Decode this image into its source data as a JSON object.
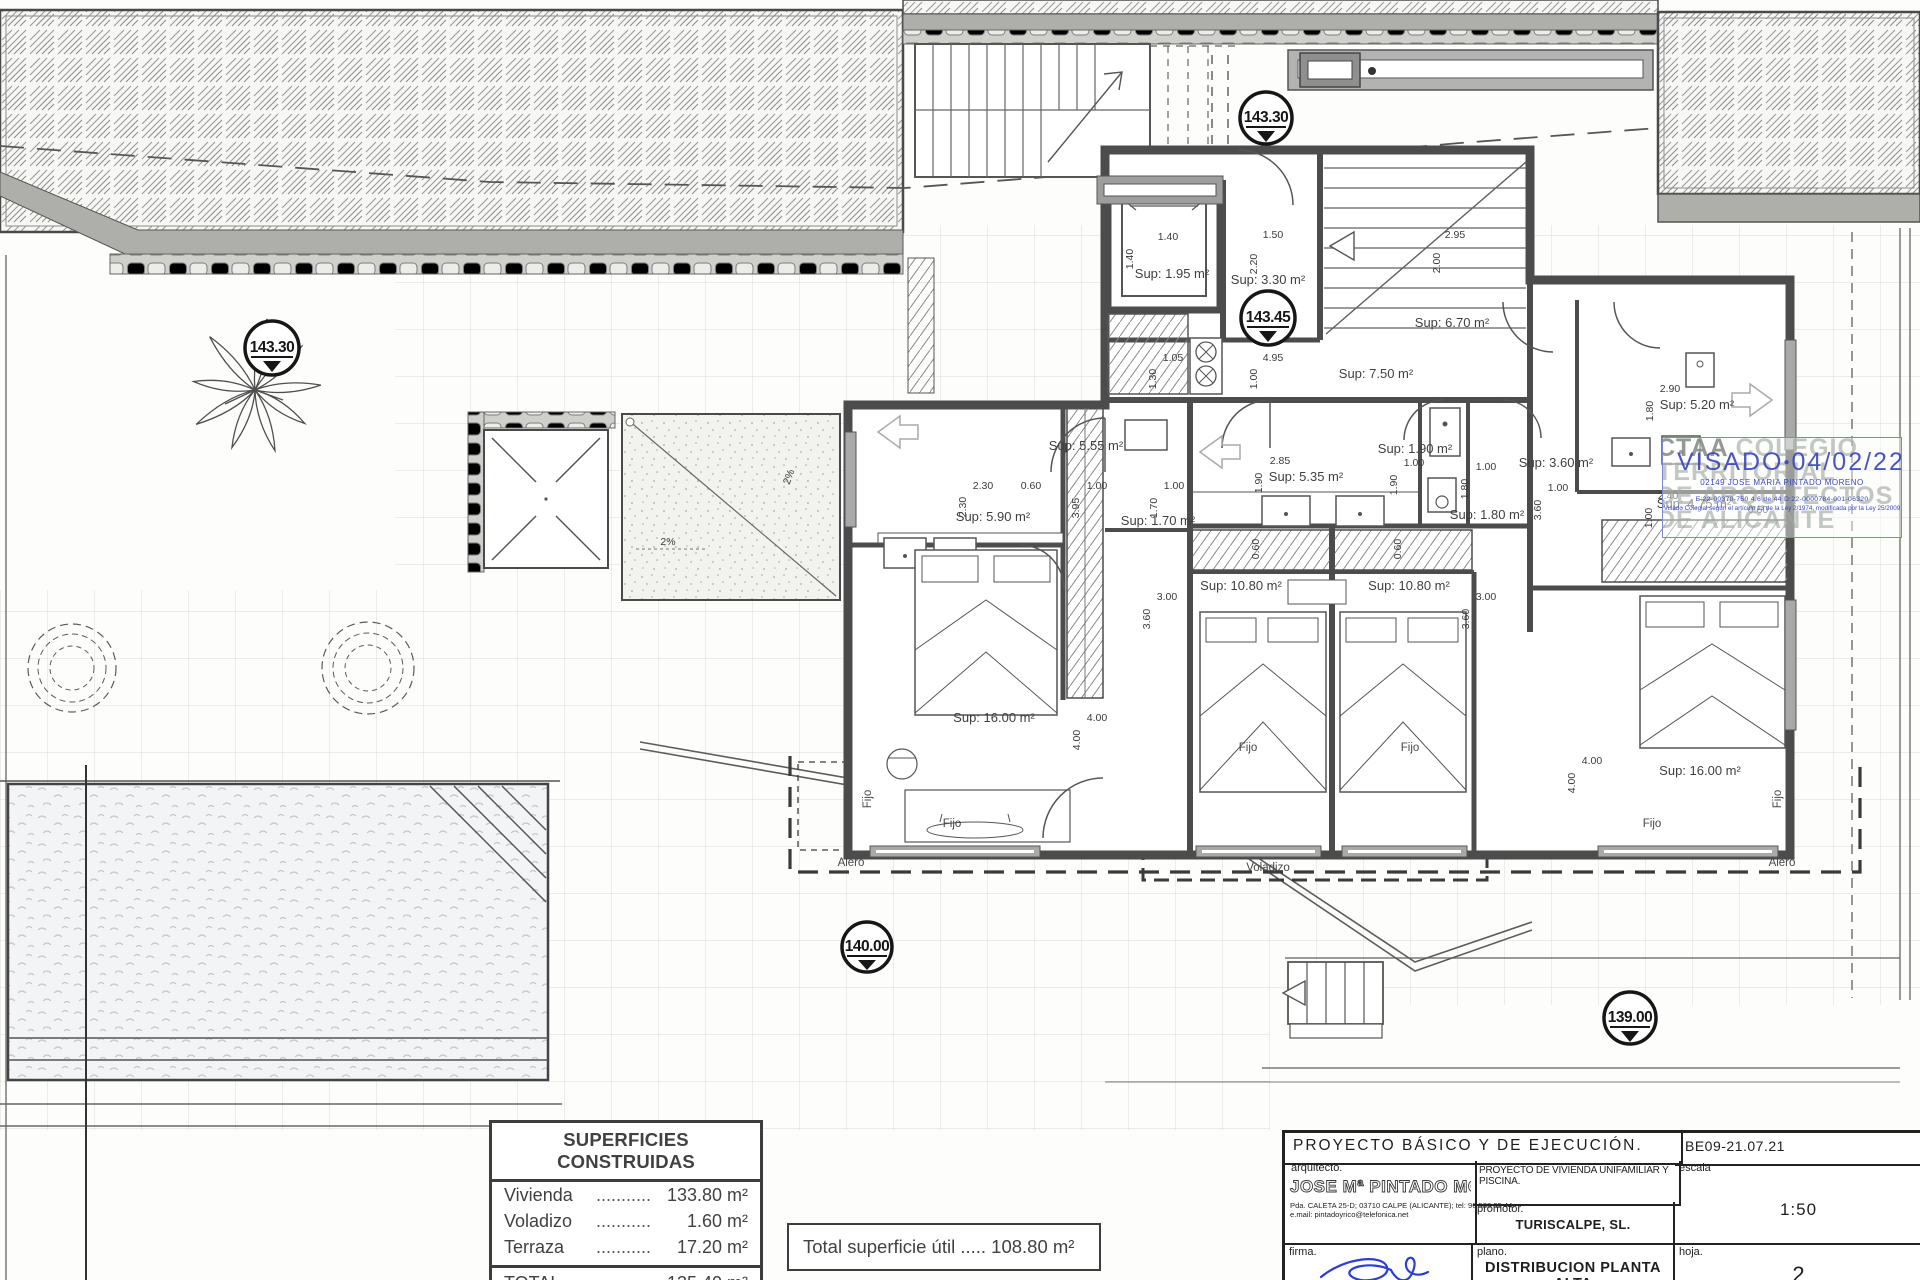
{
  "markers": [
    "143.30",
    "143.30",
    "143.45",
    "140.00",
    "139.00"
  ],
  "rooms": [
    "Sup: 1.95 m²",
    "Sup: 3.30 m²",
    "Sup: 6.70 m²",
    "Sup: 7.50 m²",
    "Sup: 5.55 m²",
    "Sup: 5.90 m²",
    "Sup: 1.70 m²",
    "Sup: 5.35 m²",
    "Sup: 1.90 m²",
    "Sup: 1.80 m²",
    "Sup: 10.80 m²",
    "Sup: 10.80 m²",
    "Sup: 3.60 m²",
    "Sup: 5.20 m²",
    "Sup: 4.75 m²",
    "Sup: 16.00 m²",
    "Sup: 16.00 m²"
  ],
  "dims": [
    "1.40",
    "1.40",
    "1.50",
    "2.20",
    "2.95",
    "2.00",
    "1.05",
    "1.30",
    "4.95",
    "1.00",
    "2.30",
    "2.30",
    "0.60",
    "1.00",
    "3.95",
    "1.00",
    "1.70",
    "2.85",
    "1.90",
    "1.00",
    "1.90",
    "1.00",
    "1.80",
    "3.00",
    "3.60",
    "0.60",
    "0.60",
    "3.00",
    "3.60",
    "2.90",
    "1.80",
    "1.00",
    "3.60",
    "2.40",
    "1.00",
    "0.60",
    "4.00",
    "4.00",
    "4.00",
    "4.00"
  ],
  "labels": {
    "fijo": "Fijo",
    "alero": "Alero",
    "voladizo": "Voladizo",
    "slope": "2%"
  },
  "stamp": {
    "org1a": "CTAA",
    "org1b": " COLEGIO",
    "org2": "TERRITORIAL",
    "org3": "DE ARQUITECTOS",
    "org4": "DE ALICANTE",
    "visado": "VISADO",
    "dot": "●",
    "date": "04/02/22",
    "colegiado": "02149 JOSE MARIA PINTADO MORENO",
    "refs": "E:22-00370-750      4.6 de 44      D:22-0000784-001-06320",
    "legal": "Visado Colegial según el artículo 13 de la Ley 2/1974, modificada por la Ley 25/2009"
  },
  "tables": {
    "superficies": {
      "title": "SUPERFICIES CONSTRUIDAS",
      "dots": "...........",
      "rows": [
        {
          "label": "Vivienda",
          "value": "133.80 m²"
        },
        {
          "label": "Voladizo",
          "value": "1.60 m²"
        },
        {
          "label": "Terraza",
          "value": "17.20 m²"
        }
      ],
      "total_label": "TOTAL",
      "total_value": "135.40 m²"
    },
    "util": "Total superficie útil ..... 108.80 m²"
  },
  "titleblock": {
    "header": "PROYECTO  BÁSICO  Y  DE  EJECUCIÓN.",
    "code": "BE09-21.07.21",
    "arquitecto_label": "arquitecto.",
    "arquitecto_name": "JOSE Mª PINTADO MORENO",
    "address": "Pda. CALETA 25-D; 03710 CALPE (ALICANTE); tel: 96 583 35 44.",
    "email": "e.mail: pintadoyrico@telefonica.net",
    "project": "PROYECTO  DE  VIVIENDA  UNIFAMILIAR  Y  PISCINA.",
    "promotor_label": "promotor.",
    "promotor": "TURISCALPE, SL.",
    "escala_label": "escala",
    "escala": "1:50",
    "firma_label": "firma.",
    "plano_label": "plano.",
    "plano": "DISTRIBUCION  PLANTA  ALTA",
    "hoja_label": "hoja.",
    "hoja": "2"
  }
}
